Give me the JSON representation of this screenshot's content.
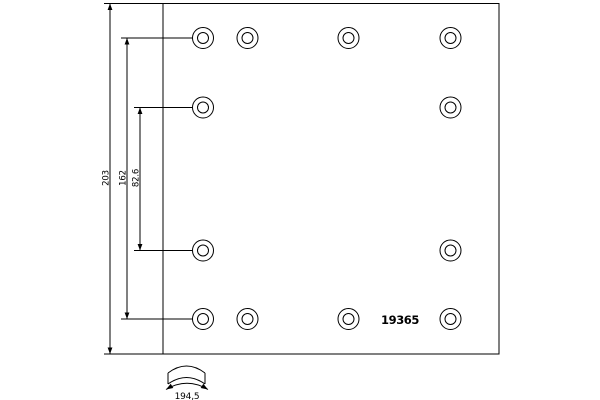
{
  "drawing": {
    "type": "technical-drawing",
    "part_number": "19365",
    "colors": {
      "line": "#000000",
      "background": "#ffffff"
    },
    "dimensions": {
      "overall_height": "203",
      "outer_hole_row_spacing": "162",
      "inner_hole_row_spacing": "82.6",
      "arc_width": "194,5"
    },
    "holes": {
      "columns_x": [
        203,
        247.5,
        348.5,
        450.5
      ],
      "rows_y": [
        38,
        107.5,
        250.5,
        319
      ],
      "pattern": [
        [
          0,
          1,
          2,
          3
        ],
        [
          0,
          3
        ],
        [
          0,
          3
        ],
        [
          0,
          1,
          2,
          3
        ]
      ],
      "outer_radius": 10.5,
      "inner_radius": 5.5
    }
  }
}
